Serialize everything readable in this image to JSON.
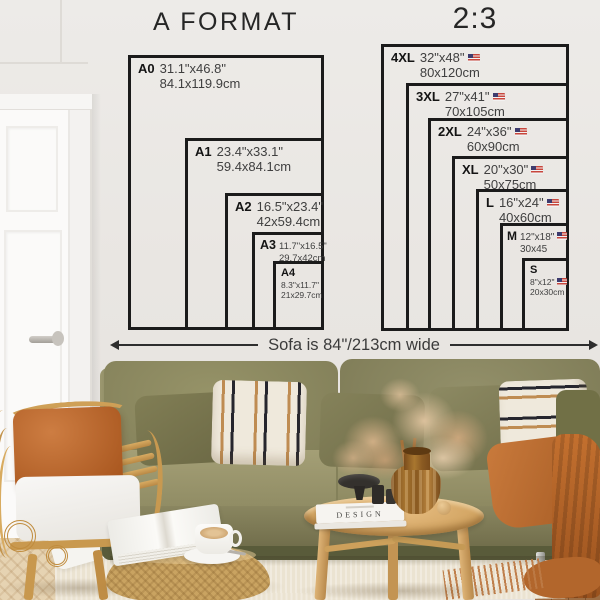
{
  "charts": [
    {
      "title": "A FORMAT",
      "sizes": [
        {
          "label": "A0",
          "inches": "31.1\"x46.8\"",
          "cm": "84.1x119.9cm"
        },
        {
          "label": "A1",
          "inches": "23.4\"x33.1\"",
          "cm": "59.4x84.1cm"
        },
        {
          "label": "A2",
          "inches": "16.5\"x23.4\"",
          "cm": "42x59.4cm"
        },
        {
          "label": "A3",
          "inches": "11.7\"x16.5\"",
          "cm": "29.7x42cm"
        },
        {
          "label": "A4",
          "inches": "8.3\"x11.7\"",
          "cm": "21x29.7cm"
        }
      ]
    },
    {
      "title": "2:3",
      "sizes": [
        {
          "label": "4XL",
          "inches": "32\"x48\"",
          "cm": "80x120cm",
          "flag": true
        },
        {
          "label": "3XL",
          "inches": "27\"x41\"",
          "cm": "70x105cm",
          "flag": true
        },
        {
          "label": "2XL",
          "inches": "24\"x36\"",
          "cm": "60x90cm",
          "flag": true
        },
        {
          "label": "XL",
          "inches": "20\"x30\"",
          "cm": "50x75cm",
          "flag": true
        },
        {
          "label": "L",
          "inches": "16\"x24\"",
          "cm": "40x60cm",
          "flag": true
        },
        {
          "label": "M",
          "inches": "12\"x18\"",
          "cm": "30x45",
          "flag": true
        },
        {
          "label": "S",
          "inches": "8\"x12\"",
          "cm": "20x30cm",
          "flag": true
        }
      ]
    }
  ],
  "sofa_note": {
    "text": "Sofa is 84\"/213cm wide"
  },
  "scene": {
    "book_spine_title": "DESIGN"
  },
  "colors": {
    "wall": "#e9e6e2",
    "chart_line": "#1b1b1b",
    "label_text": "#141414",
    "dim_text": "#3f3f3f",
    "sofa_olive": "#8a8760",
    "accent_rust": "#bc6730",
    "rattan_wood": "#d2a463",
    "rug_cream": "#ebe3d1"
  }
}
